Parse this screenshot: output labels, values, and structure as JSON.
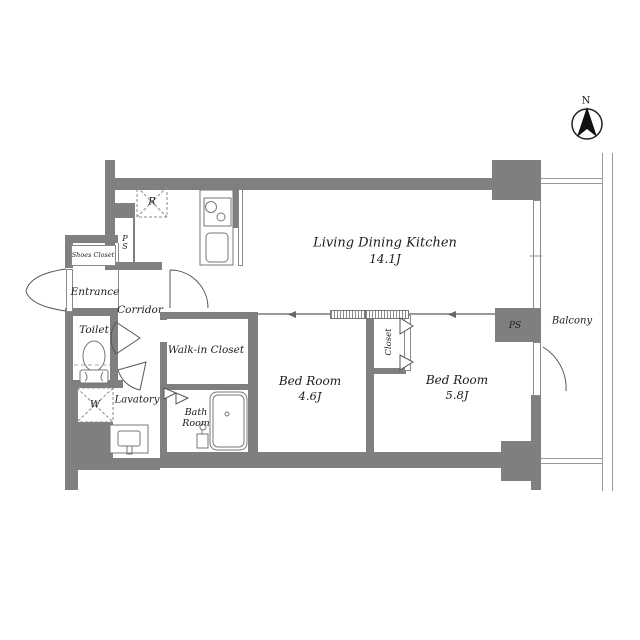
{
  "plan": {
    "title": "apartment-floor-plan",
    "compass": {
      "north_label": "N"
    },
    "rooms": {
      "ldk": {
        "name": "Living Dining Kitchen",
        "area": "14.1J"
      },
      "bedroom1": {
        "name": "Bed Room",
        "area": "4.6J"
      },
      "bedroom2": {
        "name": "Bed Room",
        "area": "5.8J"
      },
      "walk_in_closet": {
        "name": "Walk-in Closet"
      },
      "closet": {
        "name": "Closet"
      },
      "bath": {
        "line1": "Bath",
        "line2": "Room"
      },
      "lavatory": {
        "name": "Lavatory"
      },
      "toilet": {
        "name": "Toilet"
      },
      "entrance": {
        "name": "Entrance"
      },
      "corridor": {
        "name": "Corridor"
      },
      "shoes_closet": {
        "name": "Shoes Closet"
      },
      "balcony": {
        "name": "Balcony"
      }
    },
    "fixtures": {
      "refrigerator_label": "R",
      "washer_label": "W",
      "pipe_space_kitchen_label": "PS",
      "pipe_space_balcony_label": "PS"
    },
    "colors": {
      "wall": "#7f7f7f",
      "line": "#8a8a8a",
      "text": "#1c1c1c"
    }
  }
}
